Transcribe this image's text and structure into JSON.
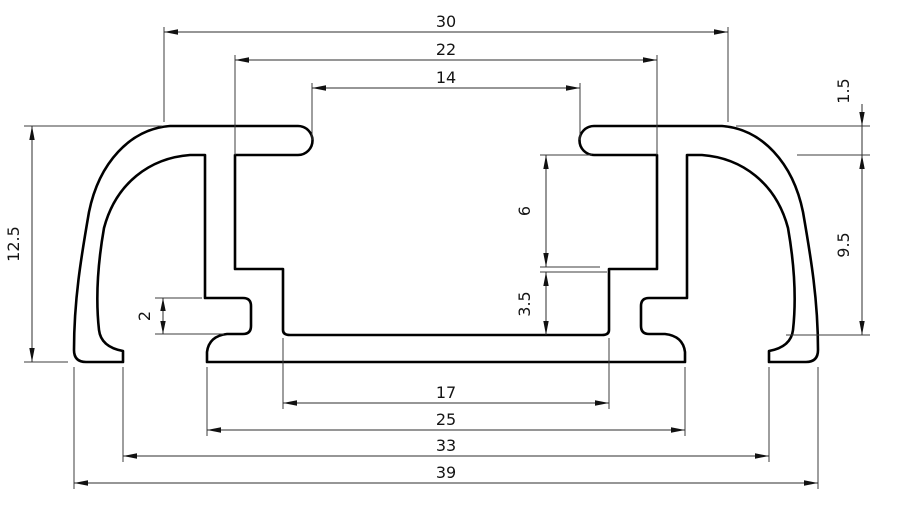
{
  "drawing": {
    "background": "#ffffff",
    "profile_line_color": "#000000",
    "dimension_line_color": "#2e2e2e",
    "dimensions": {
      "top_flange_width": "30",
      "channel_inner_width": "22",
      "slot_opening_width": "14",
      "flange_thickness": "1.5",
      "cavity_depth": "9.5",
      "overall_height": "12.5",
      "side_groove_height": "2",
      "channel_upper_depth": "6",
      "channel_lower_depth": "3.5",
      "channel_floor_width": "17",
      "stem_feet_span": "25",
      "feet_inner_span": "33",
      "overall_width": "39"
    }
  }
}
